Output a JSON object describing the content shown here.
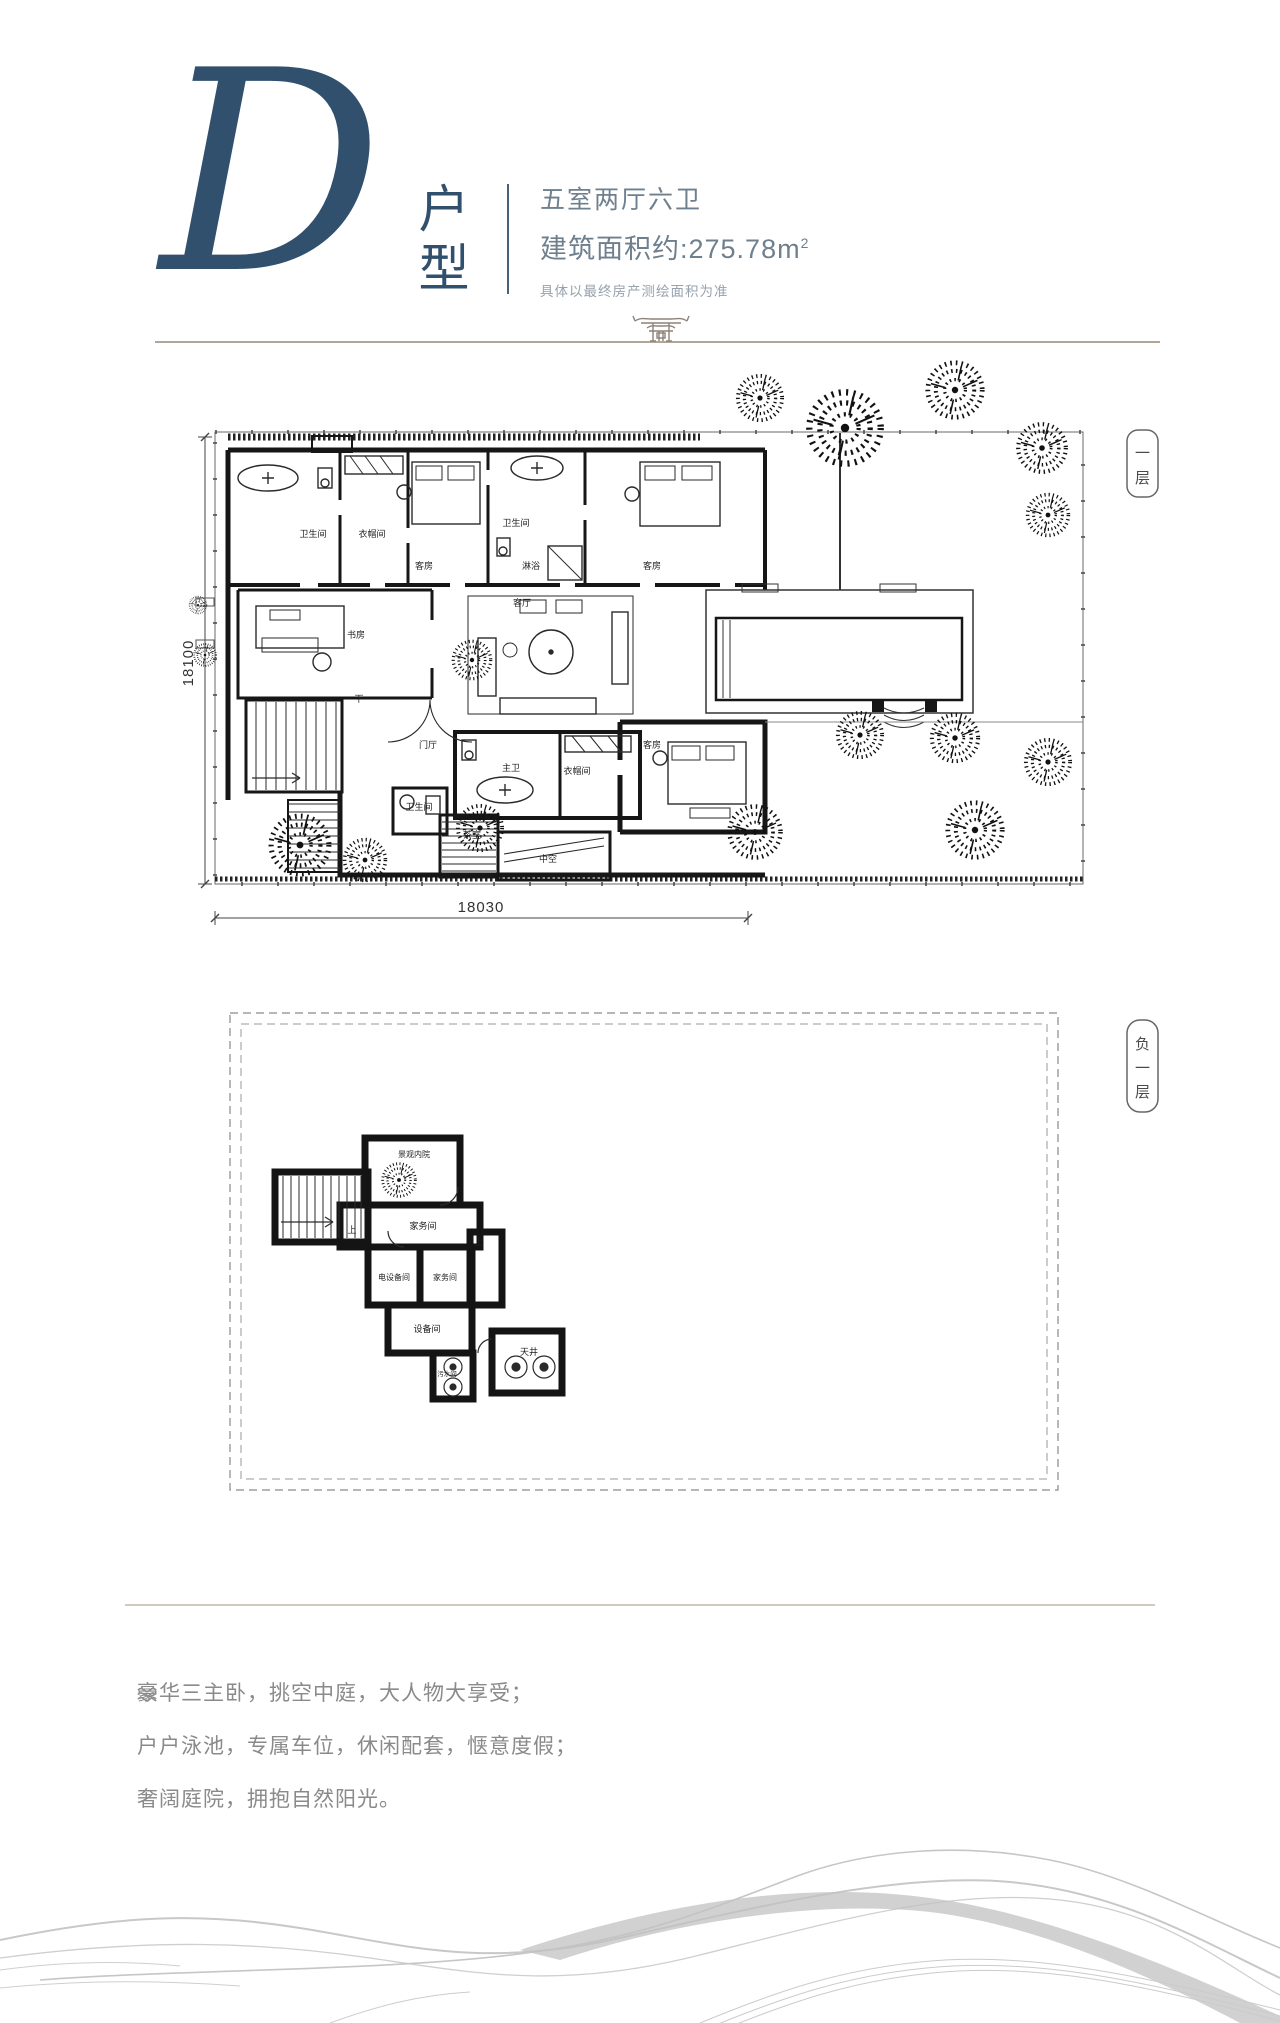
{
  "header": {
    "letter": "D",
    "type_chars": [
      "户",
      "型"
    ],
    "layout": "五室两厅六卫",
    "area_prefix": "建筑面积约:275.78m",
    "area_sup": "2",
    "disclaimer": "具体以最终房产测绘面积为准"
  },
  "floor1": {
    "tag_chars": [
      "一",
      "层"
    ],
    "dim_left": "18100",
    "dim_bottom": "18030",
    "stair_label": "下",
    "rooms": [
      "卫生间",
      "衣帽间",
      "客房",
      "卫生间",
      "淋浴",
      "客房",
      "客厅",
      "书房",
      "门厅",
      "主卫",
      "衣帽间",
      "客房",
      "卫生间",
      "茶室",
      "中空"
    ]
  },
  "basement": {
    "tag_chars": [
      "负",
      "一",
      "层"
    ],
    "up_label": "上",
    "rooms": [
      "景观内院",
      "家务间",
      "电设备间",
      "家务间",
      "设备间",
      "污水间",
      "天井"
    ]
  },
  "features": [
    "豪华三主卧，挑空中庭，大人物大享受；",
    "户户泳池，专属车位，休闲配套，惬意度假；",
    "奢阔庭院，拥抱自然阳光。"
  ],
  "colors": {
    "accent": "#30506e",
    "spec_text": "#6e7f8e",
    "divider": "#b2a698",
    "wall": "#161616",
    "feature_text": "#8a8a8a"
  }
}
